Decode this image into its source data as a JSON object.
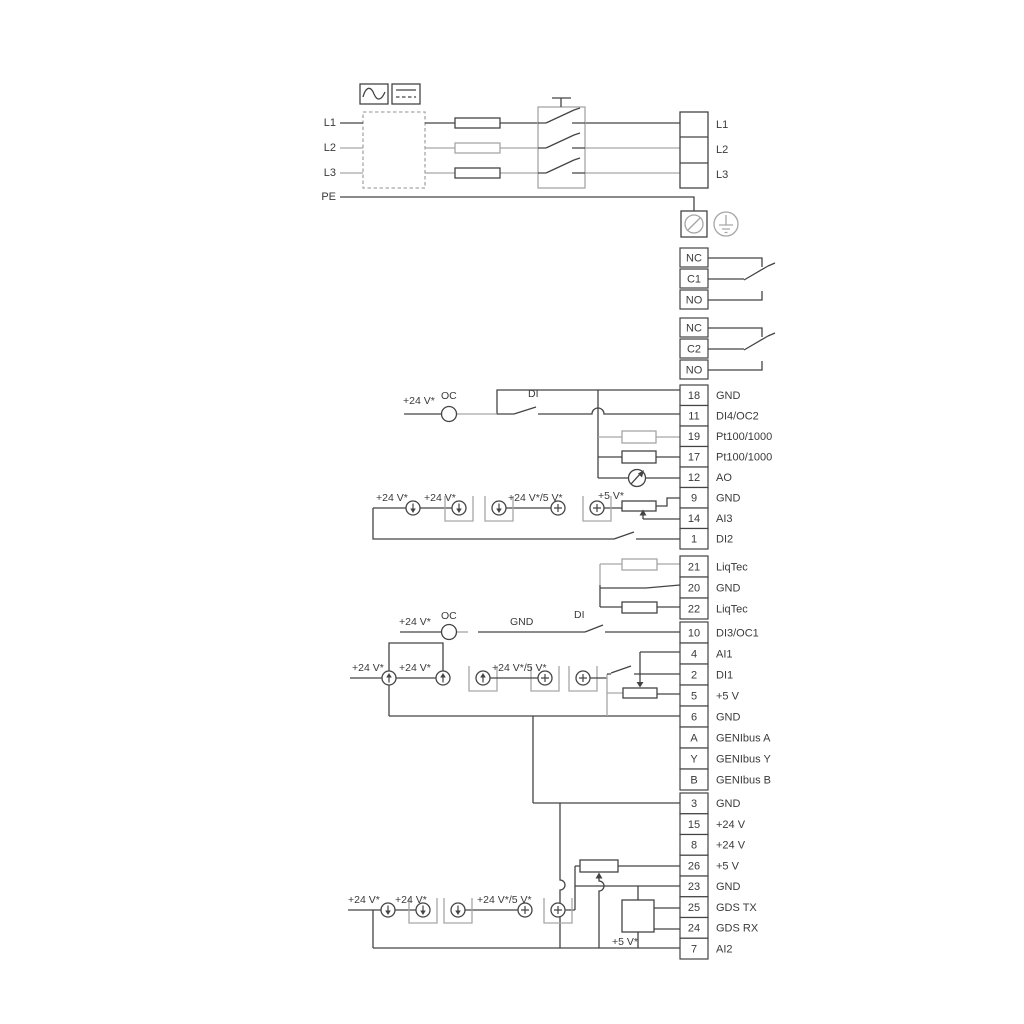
{
  "labels": {
    "p24": "+24 V*",
    "p24_5": "+24 V*/5 V*",
    "p5s": "+5 V*",
    "oc": "OC",
    "di": "DI",
    "gnd": "GND"
  },
  "power": {
    "inputs": [
      "L1",
      "L2",
      "L3",
      "PE"
    ],
    "outputs": [
      "L1",
      "L2",
      "L3"
    ]
  },
  "relays": [
    {
      "terminals": [
        "NC",
        "C1",
        "NO"
      ]
    },
    {
      "terminals": [
        "NC",
        "C2",
        "NO"
      ]
    }
  ],
  "terminal_groups": [
    {
      "name": "io-top",
      "rows": [
        {
          "num": "18",
          "label": "GND"
        },
        {
          "num": "11",
          "label": "DI4/OC2"
        },
        {
          "num": "19",
          "label": "Pt100/1000"
        },
        {
          "num": "17",
          "label": "Pt100/1000"
        },
        {
          "num": "12",
          "label": "AO"
        },
        {
          "num": "9",
          "label": "GND"
        },
        {
          "num": "14",
          "label": "AI3"
        },
        {
          "num": "1",
          "label": "DI2"
        }
      ]
    },
    {
      "name": "liqtec",
      "rows": [
        {
          "num": "21",
          "label": "LiqTec"
        },
        {
          "num": "20",
          "label": "GND"
        },
        {
          "num": "22",
          "label": "LiqTec"
        }
      ]
    },
    {
      "name": "io-mid",
      "rows": [
        {
          "num": "10",
          "label": "DI3/OC1"
        },
        {
          "num": "4",
          "label": "AI1"
        },
        {
          "num": "2",
          "label": "DI1"
        },
        {
          "num": "5",
          "label": "+5 V"
        },
        {
          "num": "6",
          "label": "GND"
        },
        {
          "num": "A",
          "label": "GENIbus A"
        },
        {
          "num": "Y",
          "label": "GENIbus Y"
        },
        {
          "num": "B",
          "label": "GENIbus B"
        }
      ]
    },
    {
      "name": "io-bottom",
      "rows": [
        {
          "num": "3",
          "label": "GND"
        },
        {
          "num": "15",
          "label": "+24 V"
        },
        {
          "num": "8",
          "label": "+24 V"
        },
        {
          "num": "26",
          "label": "+5 V"
        },
        {
          "num": "23",
          "label": "GND"
        },
        {
          "num": "25",
          "label": "GDS TX"
        },
        {
          "num": "24",
          "label": "GDS RX"
        },
        {
          "num": "7",
          "label": "AI2"
        }
      ]
    }
  ],
  "colors": {
    "wire": "#444444",
    "alt": "#a6a6a6",
    "text": "#3a3a3a"
  }
}
